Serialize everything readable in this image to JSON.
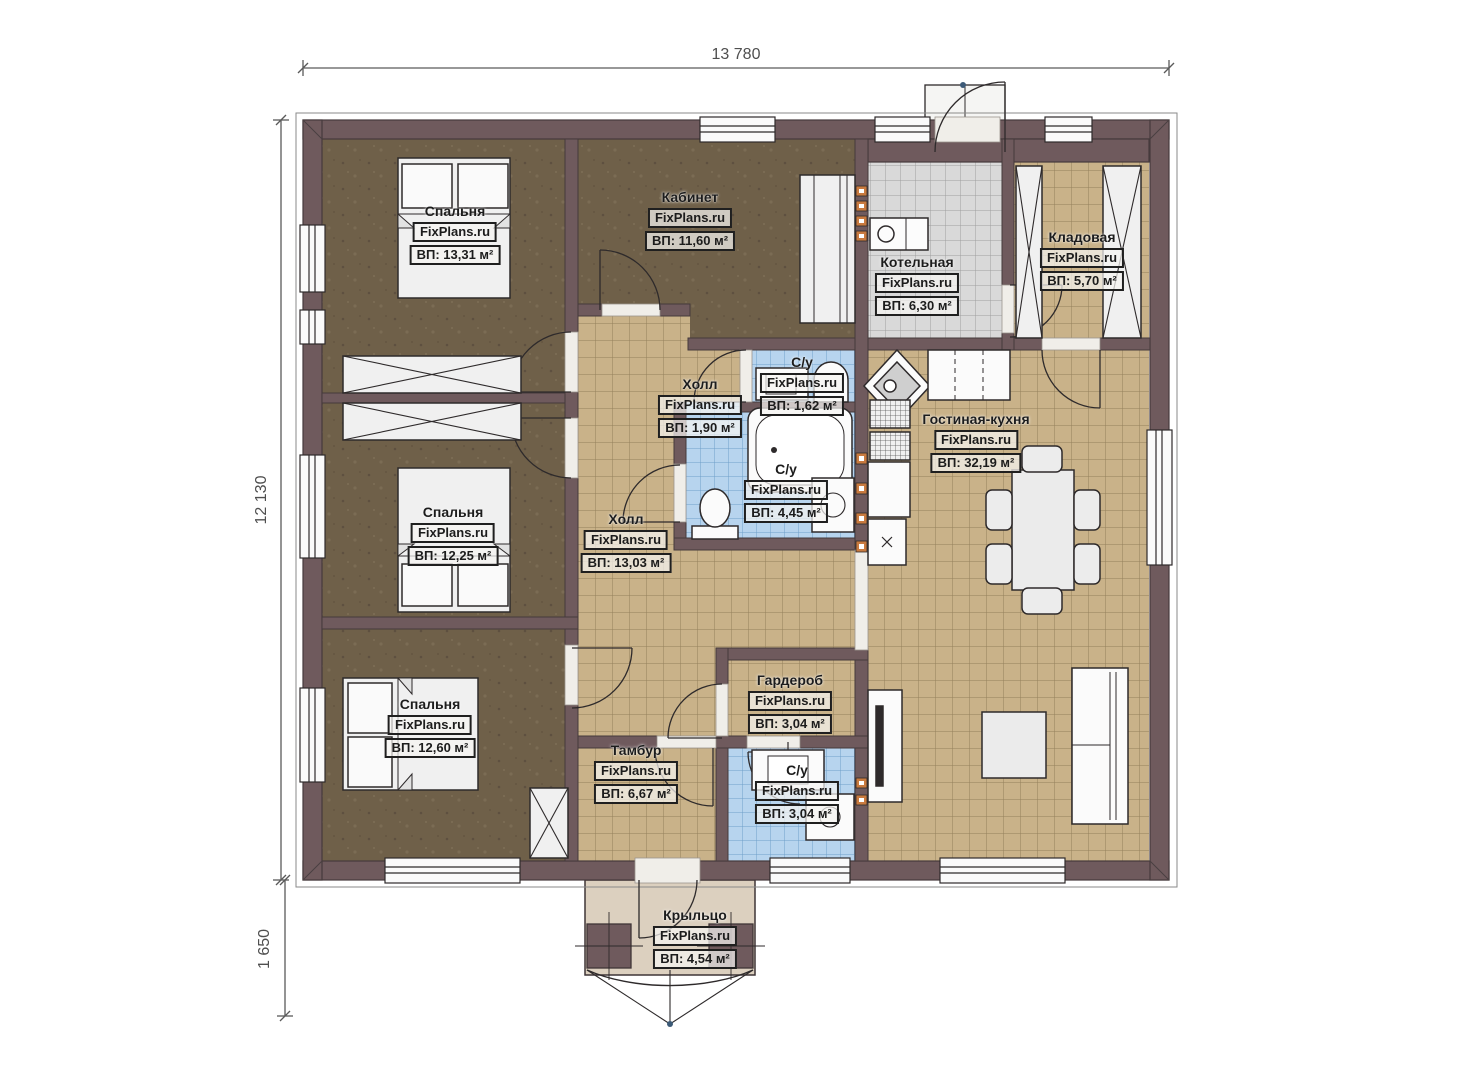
{
  "brand": "FixPlans.ru",
  "dimensions": {
    "top": "13 780",
    "left": "12 130",
    "porch": "1 650"
  },
  "rooms": [
    {
      "name": "Спальня",
      "brand": "FixPlans.ru",
      "area": "ВП: 13,31 м²"
    },
    {
      "name": "Кабинет",
      "brand": "FixPlans.ru",
      "area": "ВП: 11,60 м²"
    },
    {
      "name": "Котельная",
      "brand": "FixPlans.ru",
      "area": "ВП: 6,30 м²"
    },
    {
      "name": "Кладовая",
      "brand": "FixPlans.ru",
      "area": "ВП: 5,70 м²"
    },
    {
      "name": "Холл",
      "brand": "FixPlans.ru",
      "area": "ВП: 1,90 м²"
    },
    {
      "name": "С/у",
      "brand": "FixPlans.ru",
      "area": "ВП: 1,62 м²"
    },
    {
      "name": "С/у",
      "brand": "FixPlans.ru",
      "area": "ВП: 4,45 м²"
    },
    {
      "name": "Гостиная-кухня",
      "brand": "FixPlans.ru",
      "area": "ВП: 32,19 м²"
    },
    {
      "name": "Спальня",
      "brand": "FixPlans.ru",
      "area": "ВП: 12,25 м²"
    },
    {
      "name": "Холл",
      "brand": "FixPlans.ru",
      "area": "ВП: 13,03 м²"
    },
    {
      "name": "Спальня",
      "brand": "FixPlans.ru",
      "area": "ВП: 12,60 м²"
    },
    {
      "name": "Гардероб",
      "brand": "FixPlans.ru",
      "area": "ВП: 3,04 м²"
    },
    {
      "name": "Тамбур",
      "brand": "FixPlans.ru",
      "area": "ВП: 6,67 м²"
    },
    {
      "name": "С/у",
      "brand": "FixPlans.ru",
      "area": "ВП: 3,04 м²"
    },
    {
      "name": "Крыльцо",
      "brand": "FixPlans.ru",
      "area": "ВП: 4,54 м²"
    }
  ],
  "colors": {
    "wall": "#6f5a5d",
    "bedroom_floor": "#6f6049",
    "tile_tan": "#c9b289",
    "tile_gray": "#d9d9d9",
    "tile_blue": "#b7d4ee",
    "porch": "#dcd0bf",
    "vent_orange": "#c97a3f"
  }
}
